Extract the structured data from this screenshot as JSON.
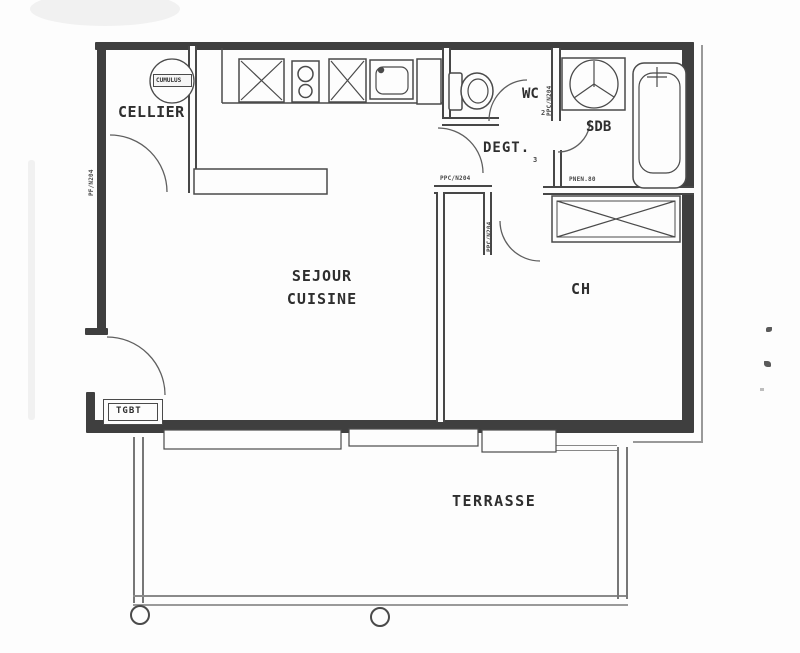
{
  "drawing": {
    "type": "apartment floor plan (scanned)",
    "rooms": {
      "cellier": "CELLIER",
      "wc": "WC",
      "sdb": "SDB",
      "degt": "DEGT.",
      "sejour_line1": "SEJOUR",
      "sejour_line2": "CUISINE",
      "ch": "CH",
      "terrasse": "TERRASSE"
    },
    "equipment": {
      "water_heater": "CUMULUS",
      "electrical_panel": "TGBT"
    },
    "codes": {
      "left_wall_window": "PF/N204",
      "wc_door": "PPC/N204",
      "wc_door_num": "2",
      "sejour_door": "PPC/N204",
      "degt_door_vertical": "PPC/N204",
      "degt_num": "3",
      "sdb_door": "PNEN.80"
    },
    "colors": {
      "wall": "#3f3f3f",
      "fixture_line": "#4a4a4a",
      "terrace_line": "#777777",
      "paper": "#fdfdfd"
    }
  }
}
